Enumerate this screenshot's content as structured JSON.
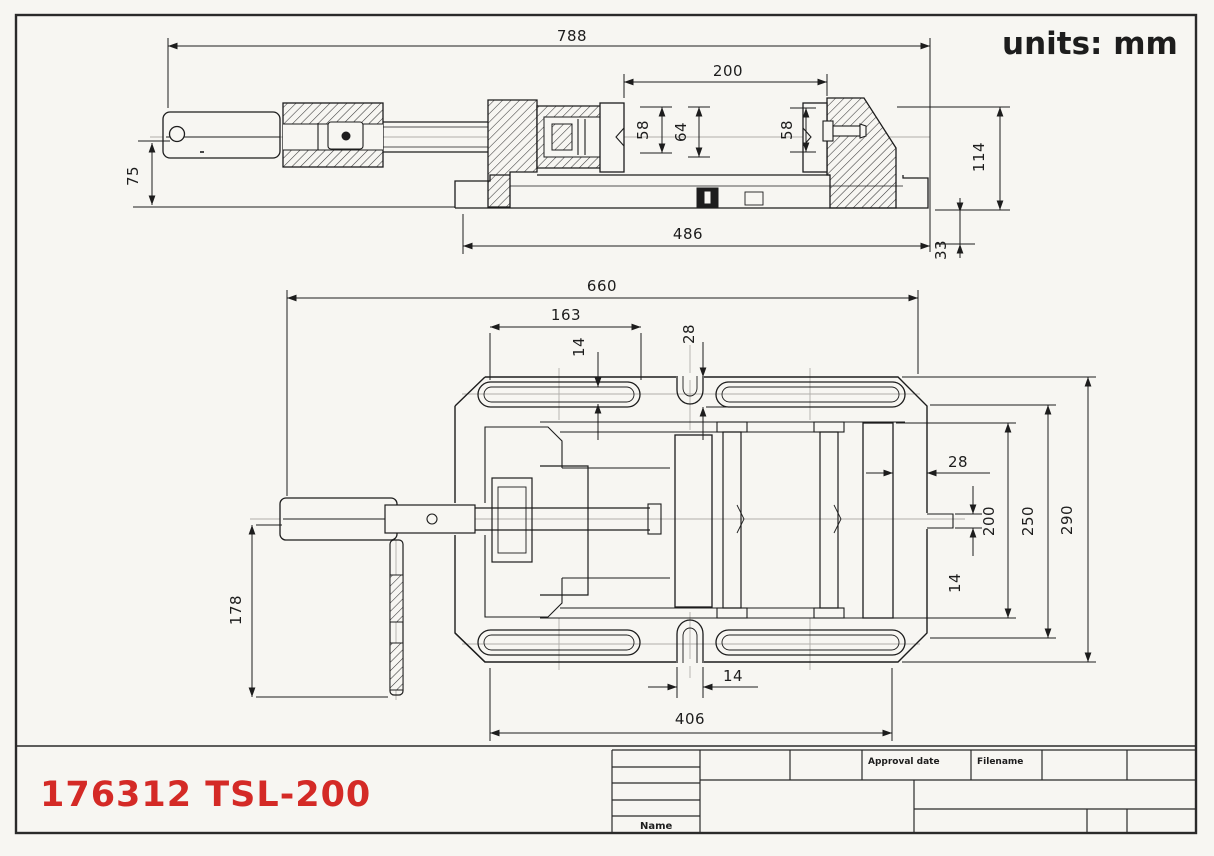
{
  "units_label": "units: mm",
  "part_label": "176312 TSL-200",
  "title_block": {
    "approval_date_label": "Approval date",
    "filename_label": "Filename",
    "name_label": "Name"
  },
  "side_view": {
    "dims": {
      "overall_length": "788",
      "jaw_opening": "200",
      "left_jaw_height": "58",
      "center_height": "64",
      "right_jaw_height": "58",
      "handle_offset": "75",
      "base_length": "486",
      "total_height": "114",
      "base_height": "33"
    }
  },
  "plan_view": {
    "dims": {
      "overall_length": "660",
      "slot_span": "163",
      "slot_width_top": "14",
      "notch_depth": "28",
      "jaw_offset": "28",
      "jaw_span": "200",
      "slot_row_span": "250",
      "overall_width": "290",
      "key_width": "14",
      "handle_length": "178",
      "notch_width": "14",
      "base_span": "406"
    }
  },
  "colors": {
    "accent_red": "#d42a26",
    "line": "#1d1d1d",
    "centerline": "#aaaaaa",
    "paper": "#f7f6f2"
  }
}
